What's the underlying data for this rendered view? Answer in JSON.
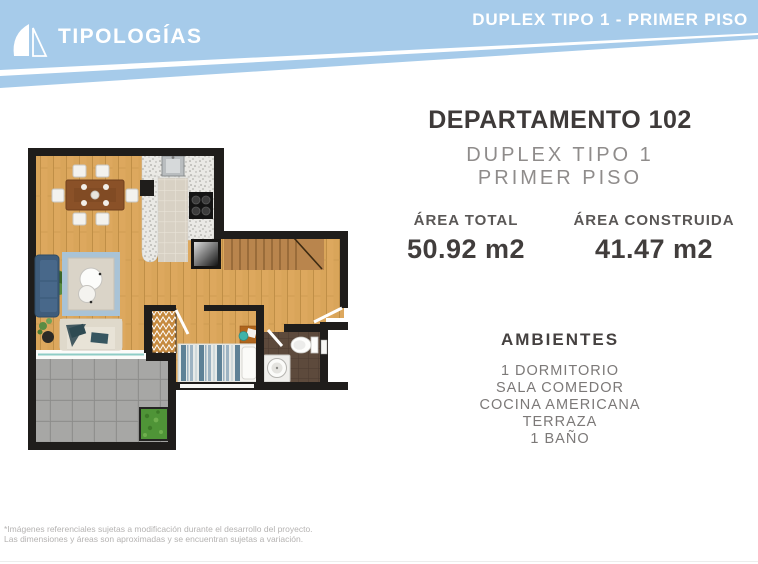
{
  "header": {
    "brand": "TIPOLOGÍAS",
    "page_label": "DUPLEX TIPO 1 - PRIMER PISO"
  },
  "unit": {
    "title": "DEPARTAMENTO 102",
    "type_line": "DUPLEX TIPO 1",
    "floor_line": "PRIMER PISO",
    "areas": [
      {
        "label": "ÁREA TOTAL",
        "value": "50.92 m2"
      },
      {
        "label": "ÁREA CONSTRUIDA",
        "value": "41.47 m2"
      }
    ],
    "ambientes_heading": "AMBIENTES",
    "ambientes": [
      "1 DORMITORIO",
      "SALA COMEDOR",
      "COCINA AMERICANA",
      "TERRAZA",
      "1 BAÑO"
    ]
  },
  "footer": {
    "line1": "*Imágenes referenciales sujetas a modificación durante el desarrollo del proyecto.",
    "line2": "Las dimensiones y áreas son aproximadas y se encuentran sujetas a variación."
  },
  "colors": {
    "header_blue": "#a6cbea",
    "title_dark": "#3e3a39",
    "muted_gray": "#8f8c8b",
    "footer_gray": "#b5b3b2",
    "plan_wall": "#1f1d1b",
    "plan_wood": "#d9a55a",
    "plan_stairs": "#b9854d",
    "plan_terrace": "#a2a2a0",
    "plan_bath_floor": "#5d4a3c",
    "plan_rug": "#a9c3d6",
    "plan_sofa_blue": "#3e5c7b",
    "plan_planter_green": "#4f9437",
    "plan_glass": "#8fcdc6"
  }
}
